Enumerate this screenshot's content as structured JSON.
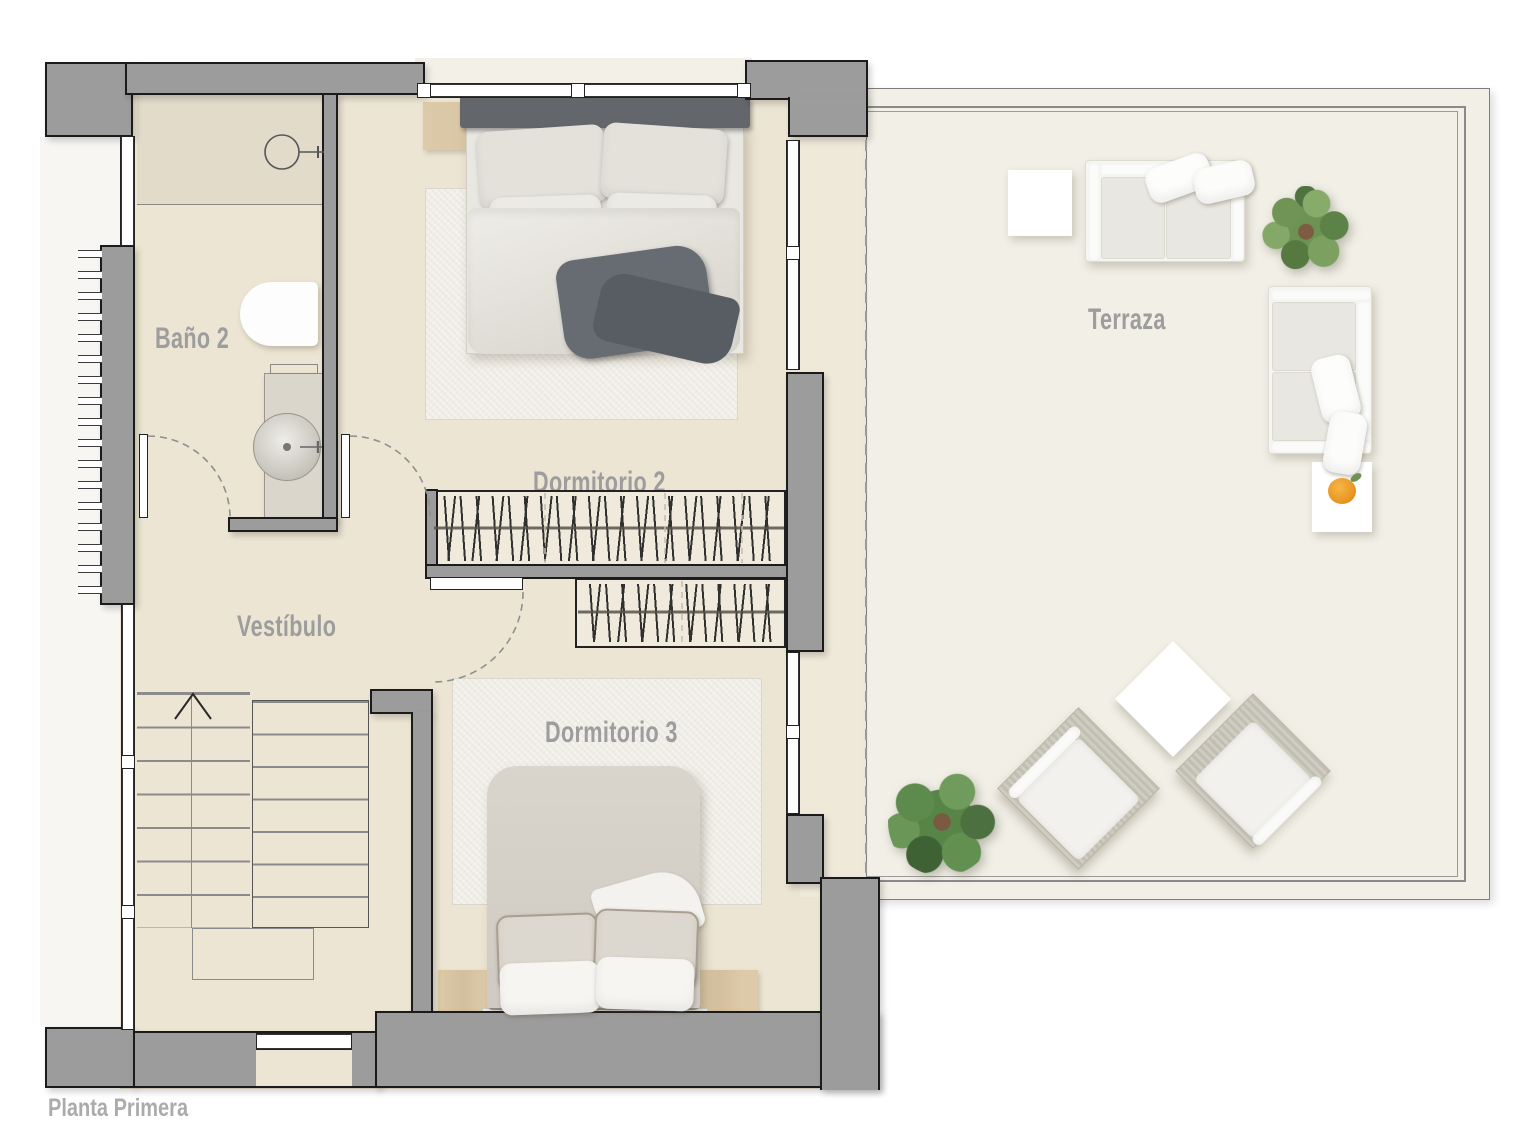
{
  "plan": {
    "title": "Planta Primera",
    "rooms": {
      "bano2": "Baño 2",
      "dormitorio2": "Dormitorio 2",
      "dormitorio3": "Dormitorio 3",
      "vestibulo": "Vestíbulo",
      "terraza": "Terraza"
    },
    "colors": {
      "wall": "#9c9c9c",
      "wall_outline": "#1b1b1b",
      "floor_interior": "#ece5d3",
      "floor_terrace": "#f1efe6",
      "label_text": "#9d9d9d",
      "wood": "#d9c6a5",
      "plant_green": "#6f9455",
      "accent_orange": "#e8951f"
    }
  }
}
